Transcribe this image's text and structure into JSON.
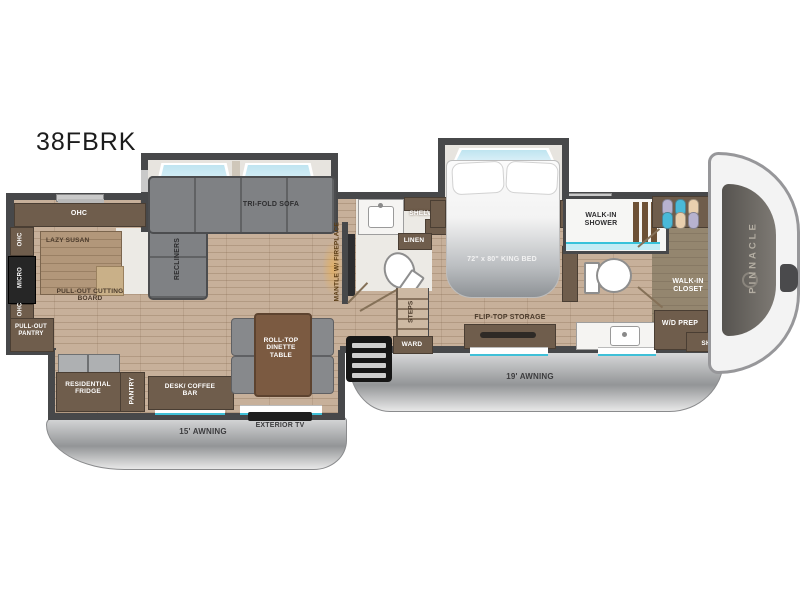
{
  "model": "38FBRK",
  "brand_logo": "PINNACLE",
  "kitchen": {
    "ohc_top": "OHC",
    "ohc_upper": "OHC",
    "micro": "MICRO",
    "ohc_lower": "OHC",
    "lazy_susan": "LAZY SUSAN",
    "pull_out_cutting_board": "PULL-OUT CUTTING BOARD",
    "pull_out_pantry": "PULL-OUT PANTRY"
  },
  "living_room": {
    "tri_fold_sofa": "TRI-FOLD SOFA",
    "recliners": "RECLINERS",
    "mantle_fireplace": "MANTLE W/ FIREPLACE",
    "dinette": "ROLL-TOP DINETTE TABLE"
  },
  "mid_bath": {
    "shelves": "SHELVES",
    "linen": "LINEN"
  },
  "hallway": {
    "steps": "STEPS",
    "ward": "WARD"
  },
  "bedroom": {
    "bed": "72\" x 80\" KING BED",
    "flip_top_storage": "FLIP-TOP STORAGE"
  },
  "master_bath": {
    "walk_in_shower": "WALK-IN SHOWER"
  },
  "closet": {
    "shelves_top": "SHELVES",
    "walk_in_closet": "WALK-IN CLOSET",
    "wd_prep": "W/D PREP",
    "shelves_bottom": "SHELVES",
    "clothes_colors": [
      "#b7b2cf",
      "#ecd2ad",
      "#3fb4d9",
      "#ecd2ad",
      "#b7b2cf",
      "#ecd2ad",
      "#3fb4d9"
    ],
    "hanger_colors": [
      "#b7b2cf",
      "#49b9d8",
      "#e9cfae",
      "#49b9d8",
      "#e9cfae",
      "#b7b2cf"
    ]
  },
  "lower_slide": {
    "residential_fridge": "RESIDENTIAL FRIDGE",
    "pantry": "PANTRY",
    "desk_coffee_bar": "DESK/ COFFEE BAR",
    "exterior_tv": "EXTERIOR TV"
  },
  "exterior": {
    "awning_19": "19' AWNING",
    "awning_15": "15' AWNING"
  },
  "colors": {
    "wall": "#47484a",
    "wood": "#c7b09a",
    "cabinet": "#6f5d4c",
    "accent_teal": "#3fc0d8",
    "window_blue": "#c2e6f2",
    "awning": "#a9abad",
    "sofa": "#7f8184"
  }
}
